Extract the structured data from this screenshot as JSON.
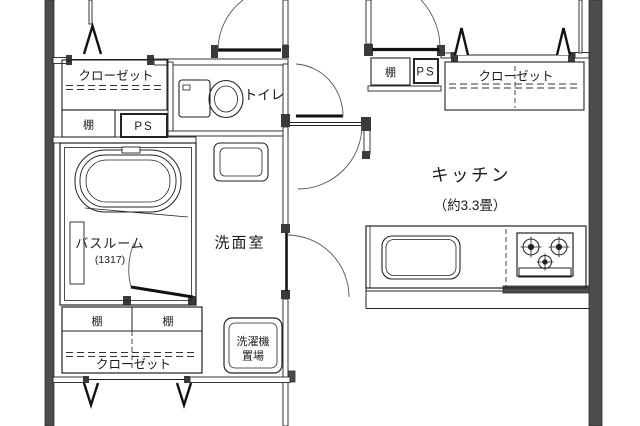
{
  "colors": {
    "background": "#ffffff",
    "line": "#222222",
    "outer_wall_fill": "#4d4d4d",
    "frame_fill": "#3a3a3a"
  },
  "labels": {
    "closet_top_left": "クローゼット",
    "shelf_top_left": "棚",
    "ps_top_left": "PS",
    "toilet": "トイレ",
    "shelf_top_right": "棚",
    "ps_top_right": "PS",
    "closet_top_right": "クローゼット",
    "kitchen": "キッチン",
    "kitchen_size": "（約3.3畳）",
    "bathroom": "バスルーム",
    "bathroom_size": "(1317)",
    "washroom": "洗面室",
    "laundry_line1": "洗濯機",
    "laundry_line2": "置場",
    "closet_bottom": "クローゼット",
    "shelf_bottom_left": "棚",
    "shelf_bottom_right": "棚"
  }
}
